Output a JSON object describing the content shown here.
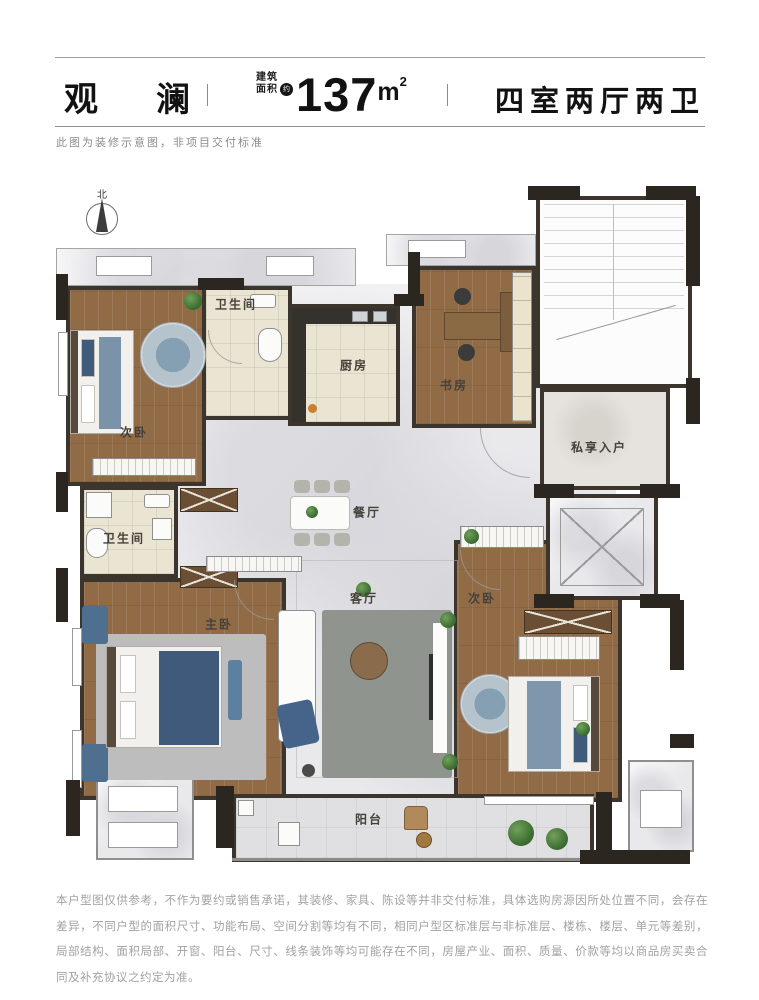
{
  "header": {
    "project_name": "观　澜",
    "divider": "|",
    "area_label_line1": "建筑",
    "area_label_line2": "面积",
    "area_approx": "约",
    "area_value": "137",
    "area_unit_base": "m",
    "area_unit_sup": "2",
    "layout_type": "四室两厅两卫"
  },
  "subtitle": "此图为装修示意图，非项目交付标准",
  "compass": {
    "label": "北"
  },
  "rooms": [
    {
      "id": "bedroom-north",
      "label": "次卧"
    },
    {
      "id": "bathroom-north",
      "label": "卫生间"
    },
    {
      "id": "kitchen",
      "label": "厨房"
    },
    {
      "id": "study",
      "label": "书房"
    },
    {
      "id": "private-entry",
      "label": "私享入户"
    },
    {
      "id": "dining-room",
      "label": "餐厅"
    },
    {
      "id": "bathroom-west",
      "label": "卫生间"
    },
    {
      "id": "master-bedroom",
      "label": "主卧"
    },
    {
      "id": "living-room",
      "label": "客厅"
    },
    {
      "id": "bedroom-east",
      "label": "次卧"
    },
    {
      "id": "balcony",
      "label": "阳台"
    }
  ],
  "disclaimer": "本户型图仅供参考，不作为要约或销售承诺，其装修、家具、陈设等并非交付标准，具体选购房源因所处位置不同，会存在差异，不同户型的面积尺寸、功能布局、空间分割等均有不同，相同户型区标准层与非标准层、楼栋、楼层、单元等差别，局部结构、面积局部、开窗、阳台、尺寸、线条装饰等均可能存在不同，房屋产业、面积、质量、价款等均以商品房买卖合同及补充协议之约定为准。",
  "colors": {
    "wall": "#3b352d",
    "wood_floor": "#916b46",
    "marble_floor": "#e9e9ec",
    "tile_floor": "#eae4d2",
    "accent_blue": "#4f6f8f",
    "plant_green": "#3f7034",
    "title_text": "#121212",
    "muted_text": "#a2a2a2"
  }
}
